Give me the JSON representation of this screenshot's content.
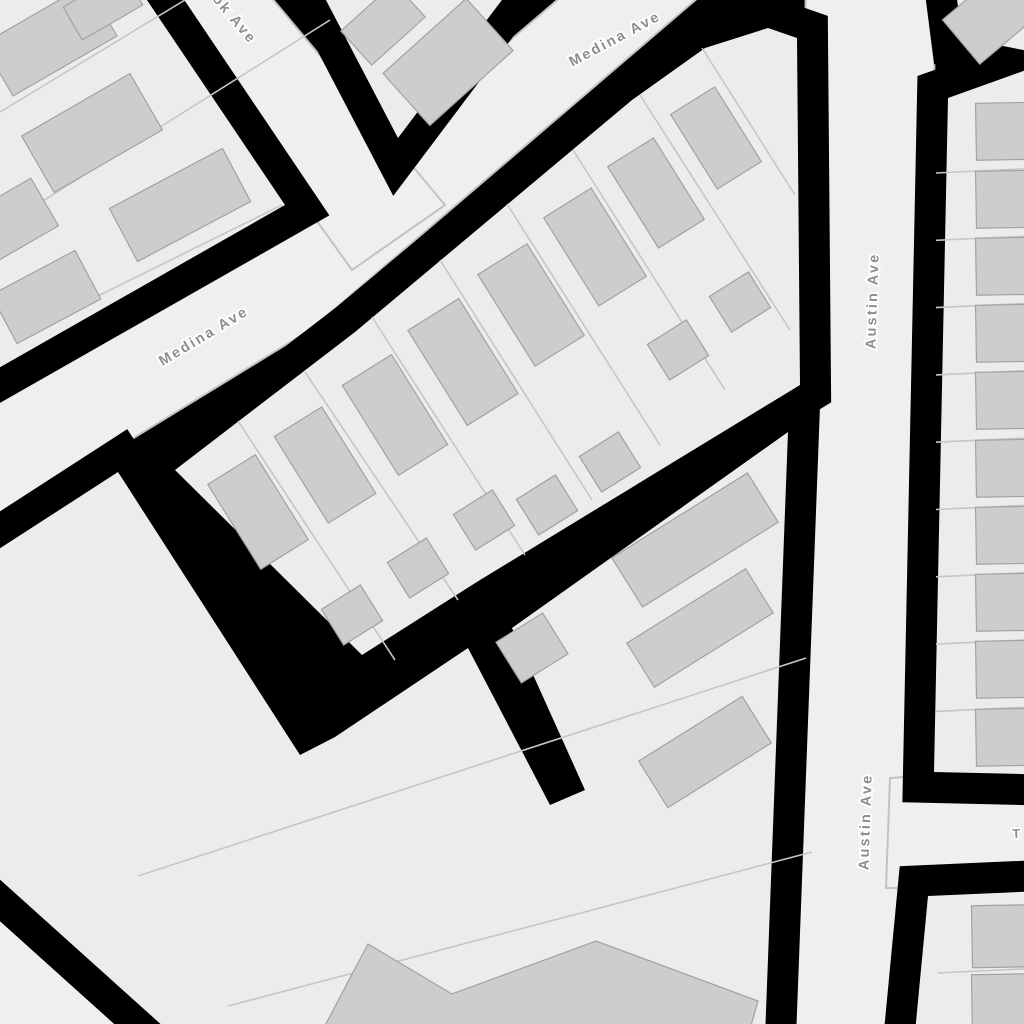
{
  "map": {
    "type": "street-map-figure-ground",
    "colors": {
      "background": "#000000",
      "road": "#efefef",
      "road_edge": "#c2c2c2",
      "block": "#ececeb",
      "parcel_line": "#c6c6c6",
      "building": "#cdcdcd",
      "building_outline": "#a2a2a2",
      "label": "#8e8e8e",
      "label_halo": "#ffffff"
    },
    "streets": [
      {
        "name": "ok Ave",
        "note": "partially cut off at top edge"
      },
      {
        "name": "Medina Ave",
        "note": "upper label"
      },
      {
        "name": "Medina Ave",
        "note": "lower-left label"
      },
      {
        "name": "Austin Ave",
        "note": "upper vertical label"
      },
      {
        "name": "Austin Ave",
        "note": "lower vertical label"
      },
      {
        "name": "T",
        "note": "street name cut off at right edge"
      }
    ]
  }
}
